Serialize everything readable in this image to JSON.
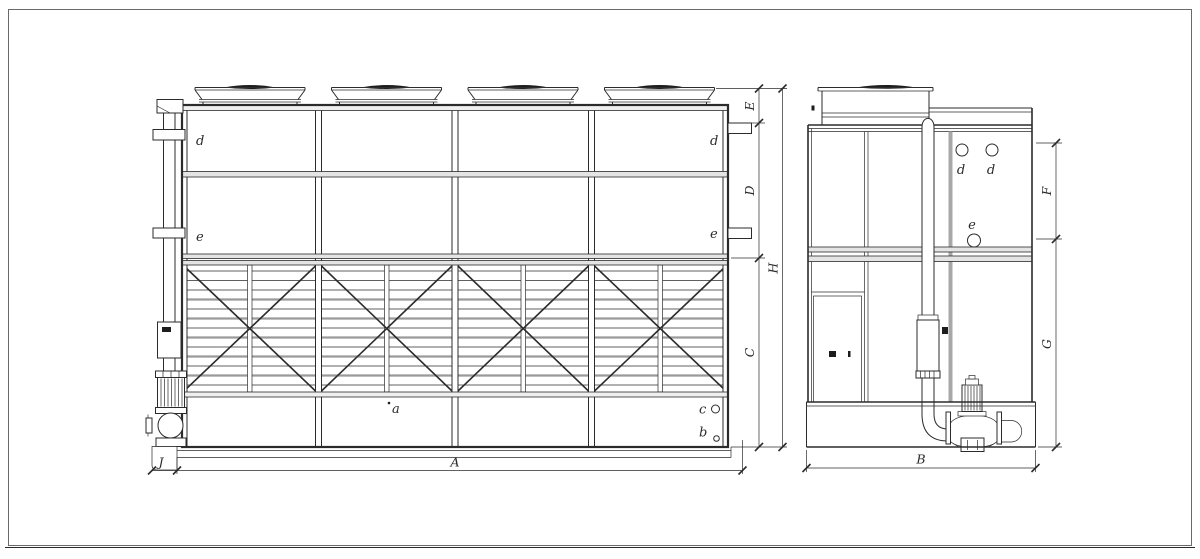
{
  "front_view": {
    "labels": {
      "d_left": "d",
      "d_right": "d",
      "e_left": "e",
      "e_right": "e",
      "a": "a",
      "b": "b",
      "c": "c"
    },
    "dimensions": {
      "A": "A",
      "C": "C",
      "D": "D",
      "E": "E",
      "H": "H",
      "J": "J"
    }
  },
  "side_view": {
    "labels": {
      "d1": "d",
      "d2": "d",
      "e": "e"
    },
    "dimensions": {
      "B": "B",
      "F": "F",
      "G": "G"
    }
  },
  "colors": {
    "line": "#2b2b2b",
    "background": "#ffffff"
  }
}
